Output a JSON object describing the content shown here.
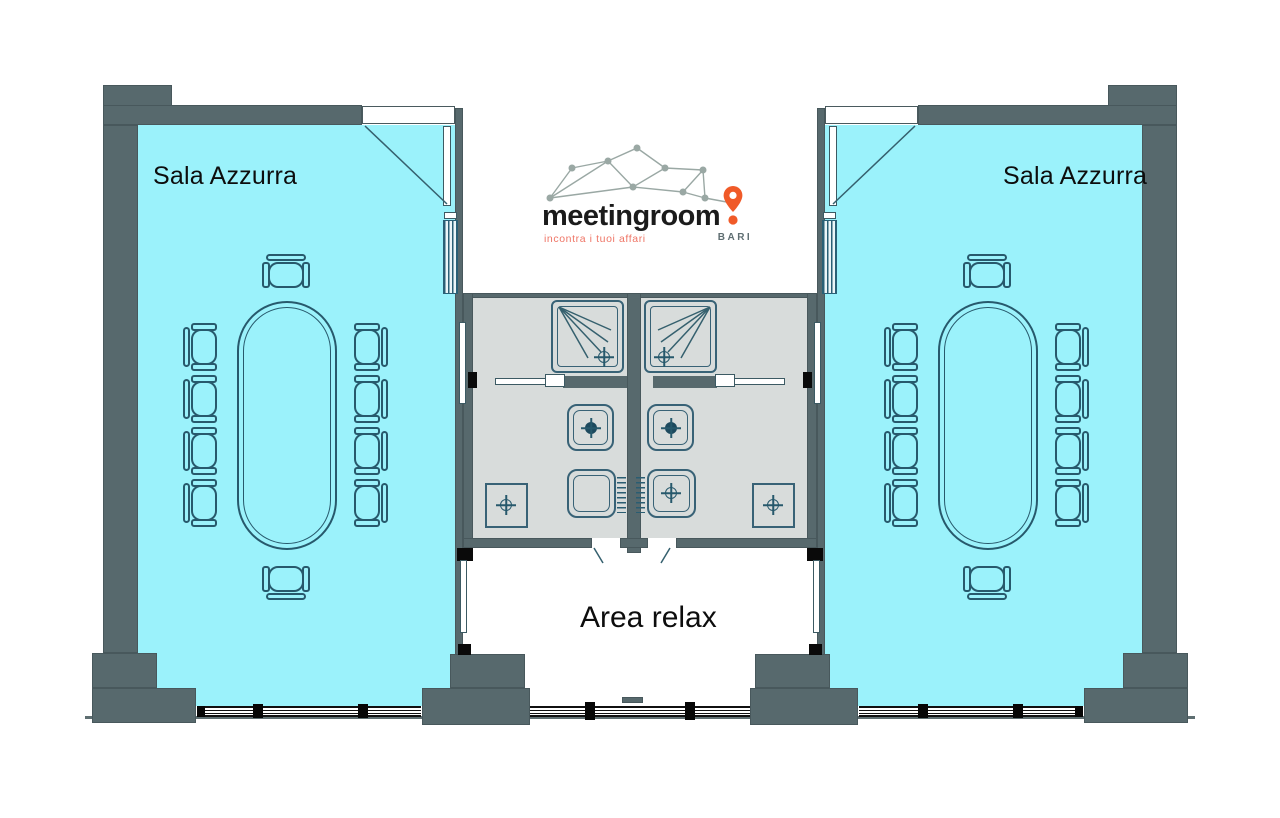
{
  "logo": {
    "brand": "meetingroom",
    "tagline": "incontra i tuoi affari",
    "city": "BARI",
    "brand_color": "#1B1B1B",
    "pin_color": "#F05A28",
    "tagline_color": "#EF7566",
    "network_color": "#9AA8A4"
  },
  "rooms": {
    "left": {
      "label": "Sala Azzurra",
      "seats": 10,
      "fill": "#9BF2FB"
    },
    "right": {
      "label": "Sala Azzurra",
      "seats": 10,
      "fill": "#9BF2FB"
    },
    "relax": {
      "label": "Area relax",
      "fill": "#FFFFFF"
    },
    "bathrooms": {
      "count": 2,
      "fill": "#D8DCDB",
      "fixtures_each": [
        "shower",
        "toilet",
        "washbasin",
        "floor-drain"
      ]
    }
  },
  "colors": {
    "wall": "#57696D",
    "furniture_line": "#27596C",
    "window_frame": "#101010",
    "background": "#FFFFFF"
  }
}
